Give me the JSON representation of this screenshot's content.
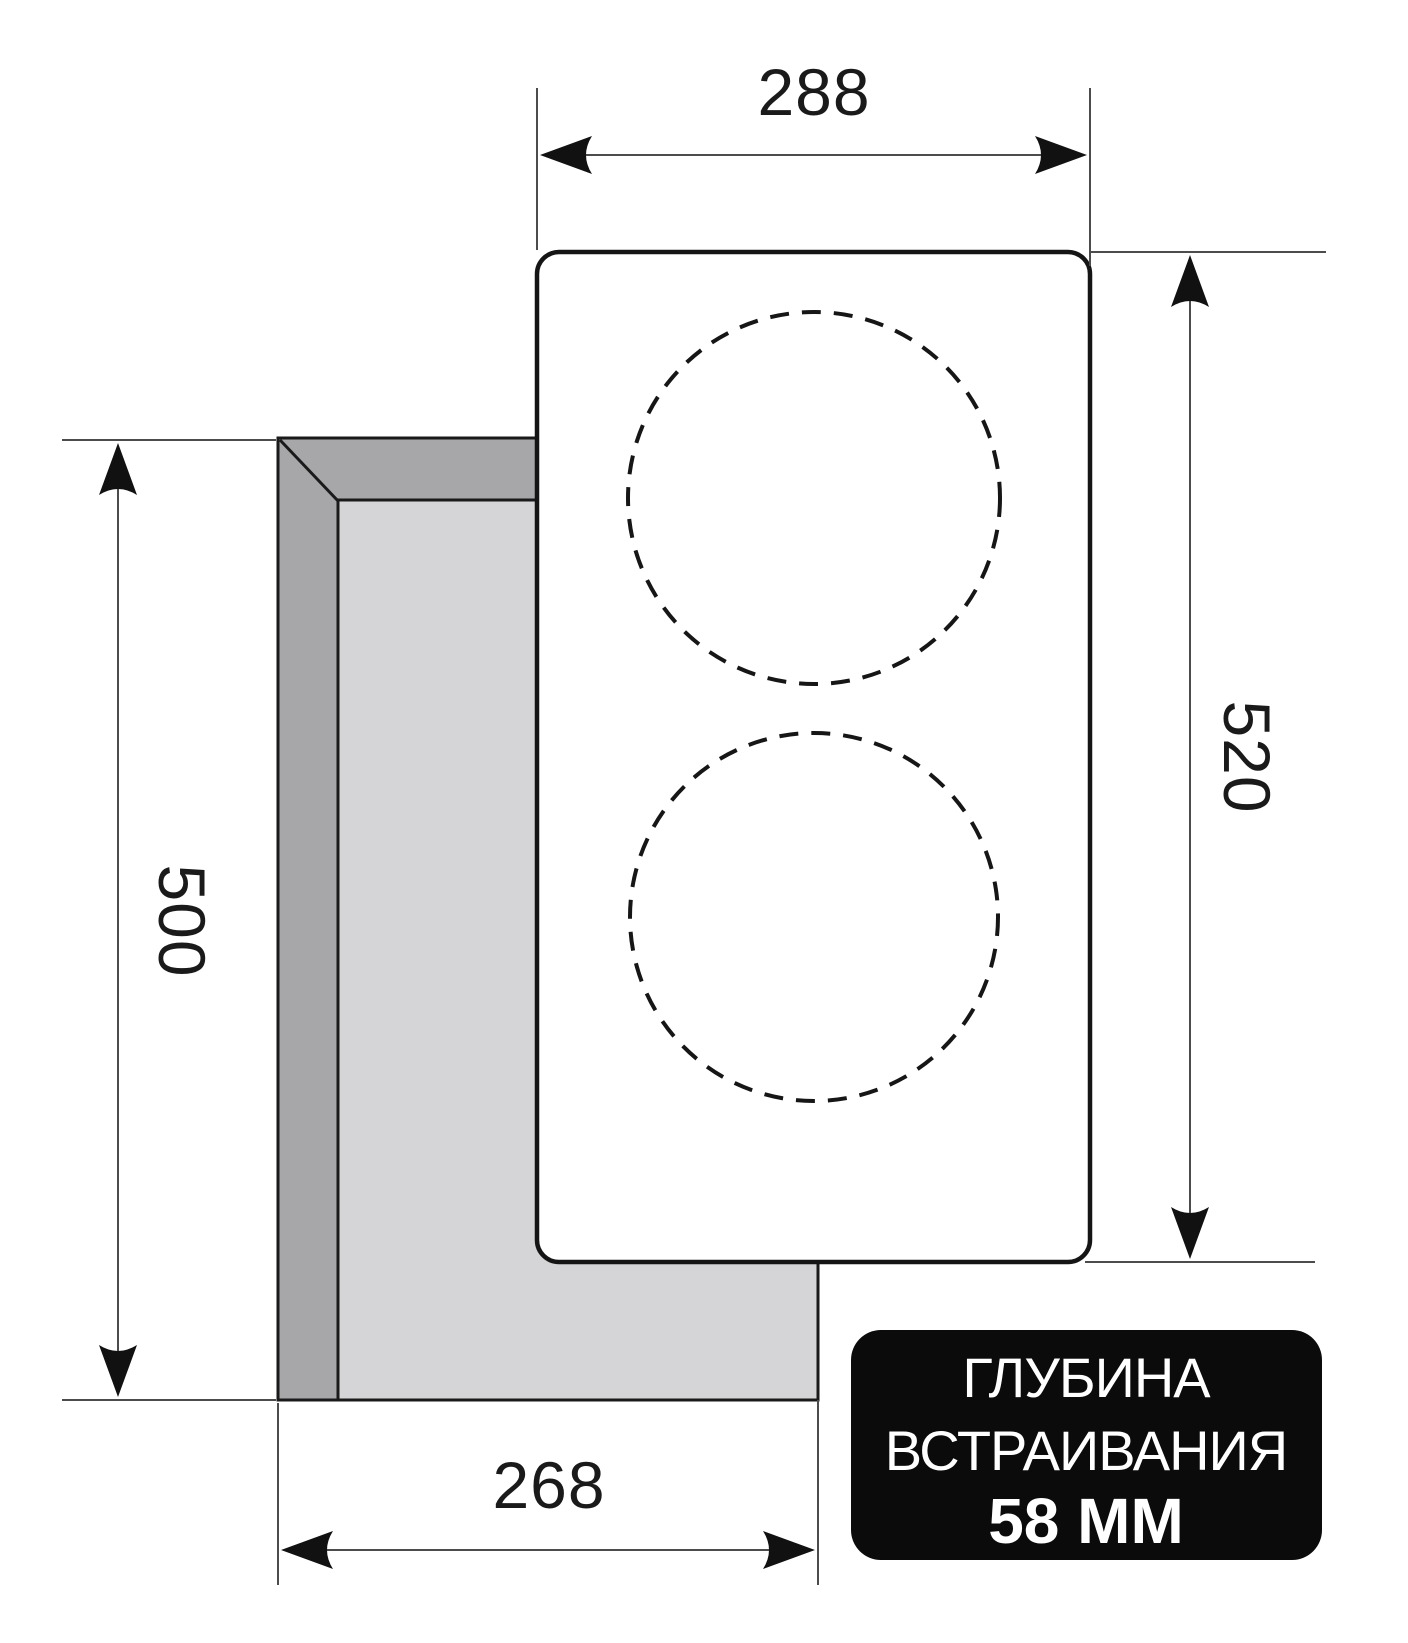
{
  "diagram": {
    "dimensions": {
      "panel_width_mm": "288",
      "panel_height_mm": "520",
      "cutout_height_mm": "500",
      "cutout_width_mm": "268"
    },
    "badge": {
      "line1": "ГЛУБИНА",
      "line2": "ВСТРАИВАНИЯ",
      "line3": "58 ММ"
    },
    "colors": {
      "cutout_side_gray": "#a7a7aa",
      "cutout_top_gray": "#d5d5d7",
      "panel_fill": "#ffffff",
      "badge_bg": "#0b0b0b",
      "badge_text": "#ffffff"
    }
  }
}
